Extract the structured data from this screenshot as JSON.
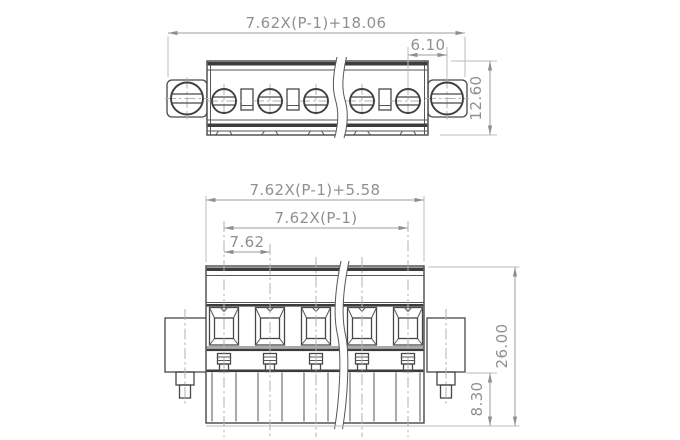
{
  "views": {
    "top": {
      "dims": {
        "overall_width": "7.62X(P-1)+18.06",
        "mount_offset": "6.10",
        "depth": "12.60"
      }
    },
    "front": {
      "dims": {
        "body_width": "7.62X(P-1)+5.58",
        "pole_span": "7.62X(P-1)",
        "pitch": "7.62",
        "height": "26.00",
        "lower_height": "8.30"
      }
    }
  },
  "colors": {
    "outline": "#474747",
    "dimension": "#9e9e9e",
    "centerline": "#b2b2b2",
    "background": "#ffffff"
  }
}
